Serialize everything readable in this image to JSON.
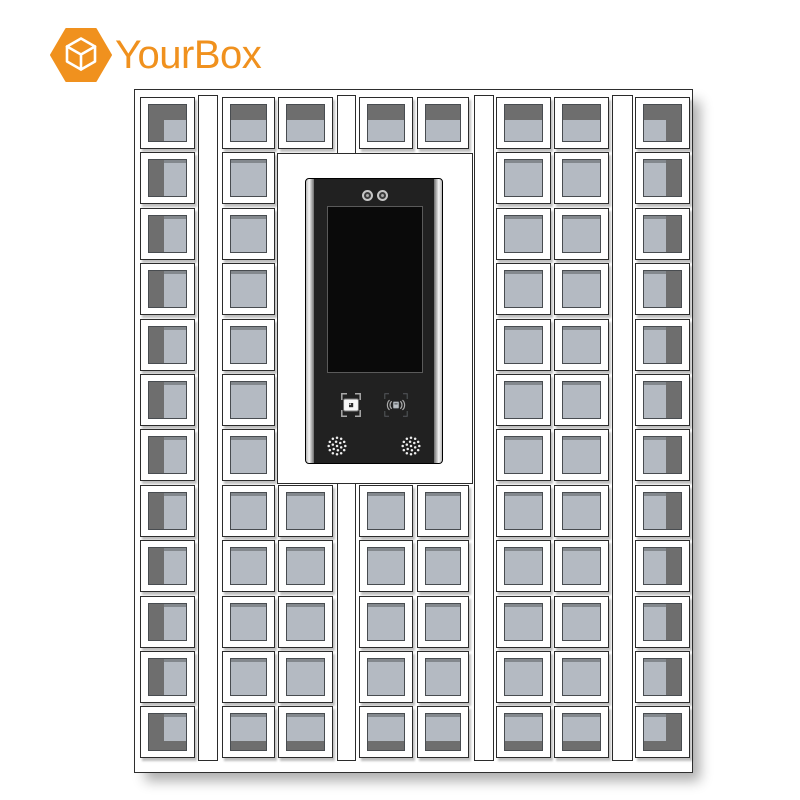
{
  "page": {
    "background": "#ffffff"
  },
  "logo": {
    "text": "YourBox",
    "color": "#F0911E",
    "icon": "hexagon-cube",
    "cube_stroke": "#ffffff"
  },
  "machine": {
    "description": "smart parcel locker cabinet with central control panel",
    "frame": {
      "x": 134,
      "y": 89,
      "w": 557,
      "h": 682
    },
    "grid": {
      "row_count": 12,
      "row_top": 7,
      "row_pitch": 55.4,
      "row_height": 52,
      "center_rows": [
        0,
        7,
        8,
        9,
        10,
        11
      ]
    },
    "strip_span": {
      "y": 5,
      "h": 666
    },
    "strips": [
      {
        "x": 63,
        "w": 20
      },
      {
        "x": 202,
        "w": 19
      },
      {
        "x": 339,
        "w": 20
      },
      {
        "x": 477,
        "w": 21
      }
    ],
    "columns": [
      {
        "id": "column-1",
        "x": 5,
        "w": 55,
        "shade": "left",
        "rows": "all"
      },
      {
        "id": "column-2",
        "x": 87,
        "w": 53,
        "shade": "none",
        "rows": "all"
      },
      {
        "id": "column-3",
        "x": 143,
        "w": 55,
        "shade": "none",
        "rows": "center"
      },
      {
        "id": "column-4",
        "x": 224,
        "w": 54,
        "shade": "none",
        "rows": "center"
      },
      {
        "id": "column-5",
        "x": 282,
        "w": 52,
        "shade": "none",
        "rows": "center"
      },
      {
        "id": "column-6",
        "x": 361,
        "w": 55,
        "shade": "none",
        "rows": "all"
      },
      {
        "id": "column-7",
        "x": 419,
        "w": 55,
        "shade": "none",
        "rows": "all"
      },
      {
        "id": "column-8",
        "x": 500,
        "w": 55,
        "shade": "right",
        "rows": "all"
      }
    ],
    "locker_total": 78,
    "door_bands": {
      "top": 15,
      "bottom": 9,
      "side": 15
    },
    "surround": {
      "x": 142,
      "y": 63,
      "w": 196,
      "h": 331
    },
    "panel": {
      "x": 27,
      "y": 24,
      "w": 138,
      "h": 286,
      "screen": {
        "x": 21,
        "y": 27,
        "w": 96,
        "h": 167
      },
      "cameras": [
        {
          "cx": 61,
          "cy": 16.5
        },
        {
          "cx": 76.5,
          "cy": 16.5
        }
      ],
      "scanner": {
        "x": 35,
        "y": 214,
        "w": 20,
        "h": 24
      },
      "rfid": {
        "x": 78,
        "y": 214,
        "w": 24,
        "h": 24
      },
      "speakers": [
        {
          "cx": 31,
          "cy": 267
        },
        {
          "cx": 105,
          "cy": 267
        }
      ],
      "speaker_radius": 11
    },
    "colors": {
      "frame_border": "#2e2e2e",
      "cell_border": "#2b2b2b",
      "door_fill": "#b4bac2",
      "door_border": "#484c50",
      "door_bevel": "#83888d",
      "door_shade": "#6e6e6e",
      "panel_body": "#212121",
      "screen_fill": "#0a0a0a",
      "screen_border": "#5a5a5a",
      "icon_light": "#a9a9a9",
      "icon_dim": "#55595d",
      "speaker_dot": "#ededed"
    }
  }
}
